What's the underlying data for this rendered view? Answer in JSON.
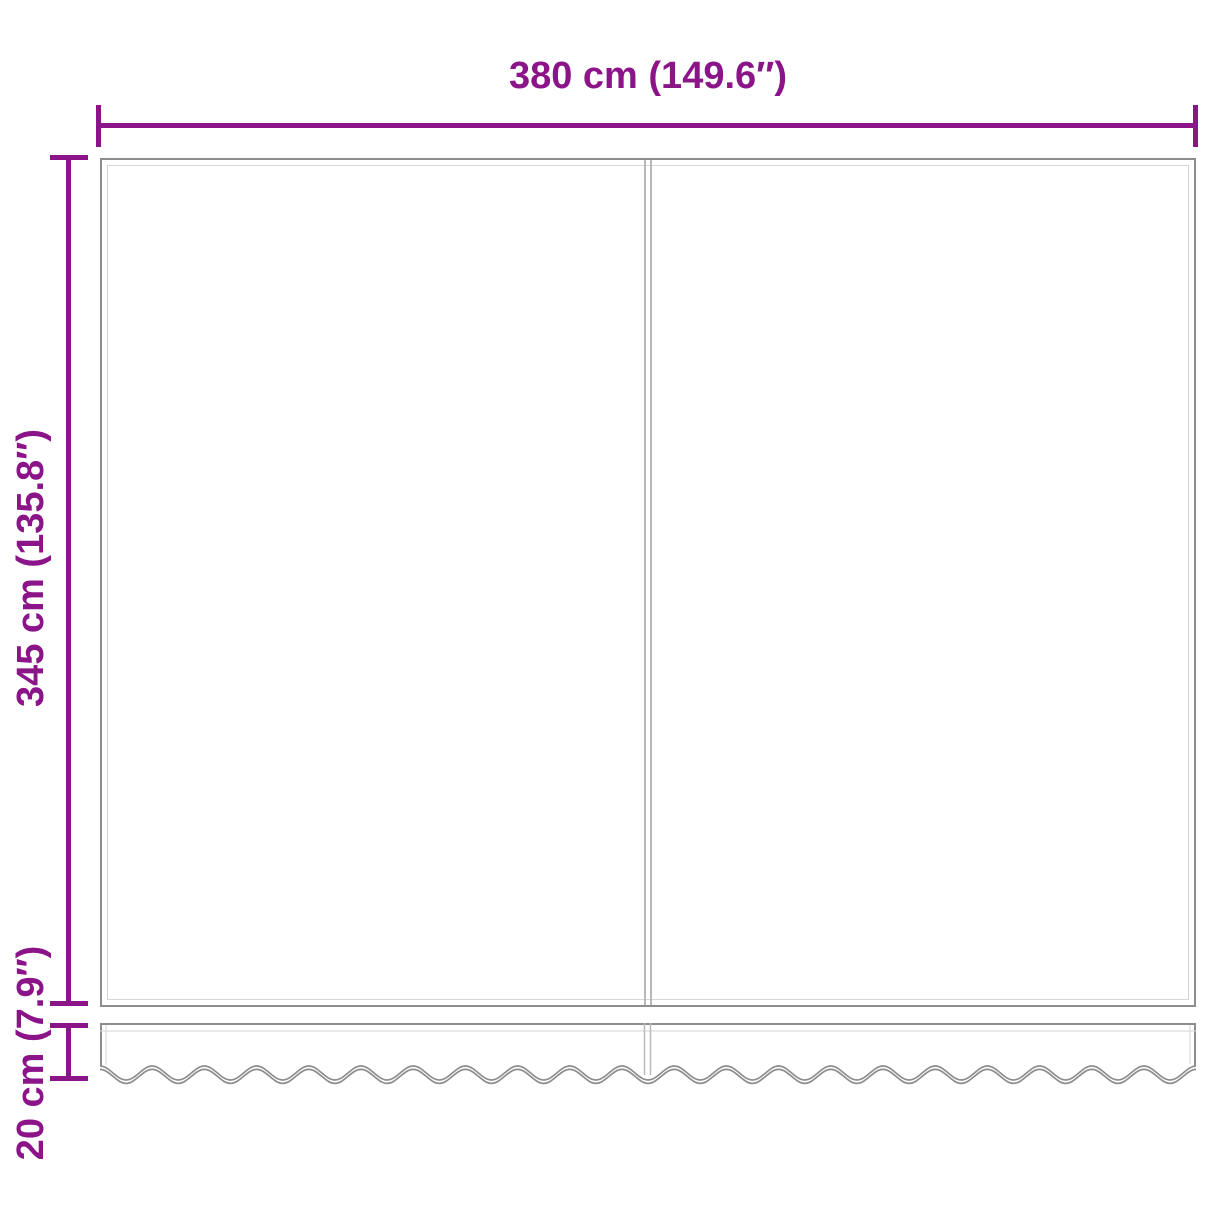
{
  "diagram": {
    "kind": "product-dimension-diagram",
    "labels": {
      "width": "380 cm (149.6″)",
      "height": "345 cm (135.8″)",
      "valance_height": "20 cm (7.9″)"
    }
  },
  "colors": {
    "dimension": "#8C1489",
    "outline": "#8d8d8d",
    "stitch": "#d6d6d6",
    "seam": "#b8b8b8",
    "background": "#ffffff"
  }
}
